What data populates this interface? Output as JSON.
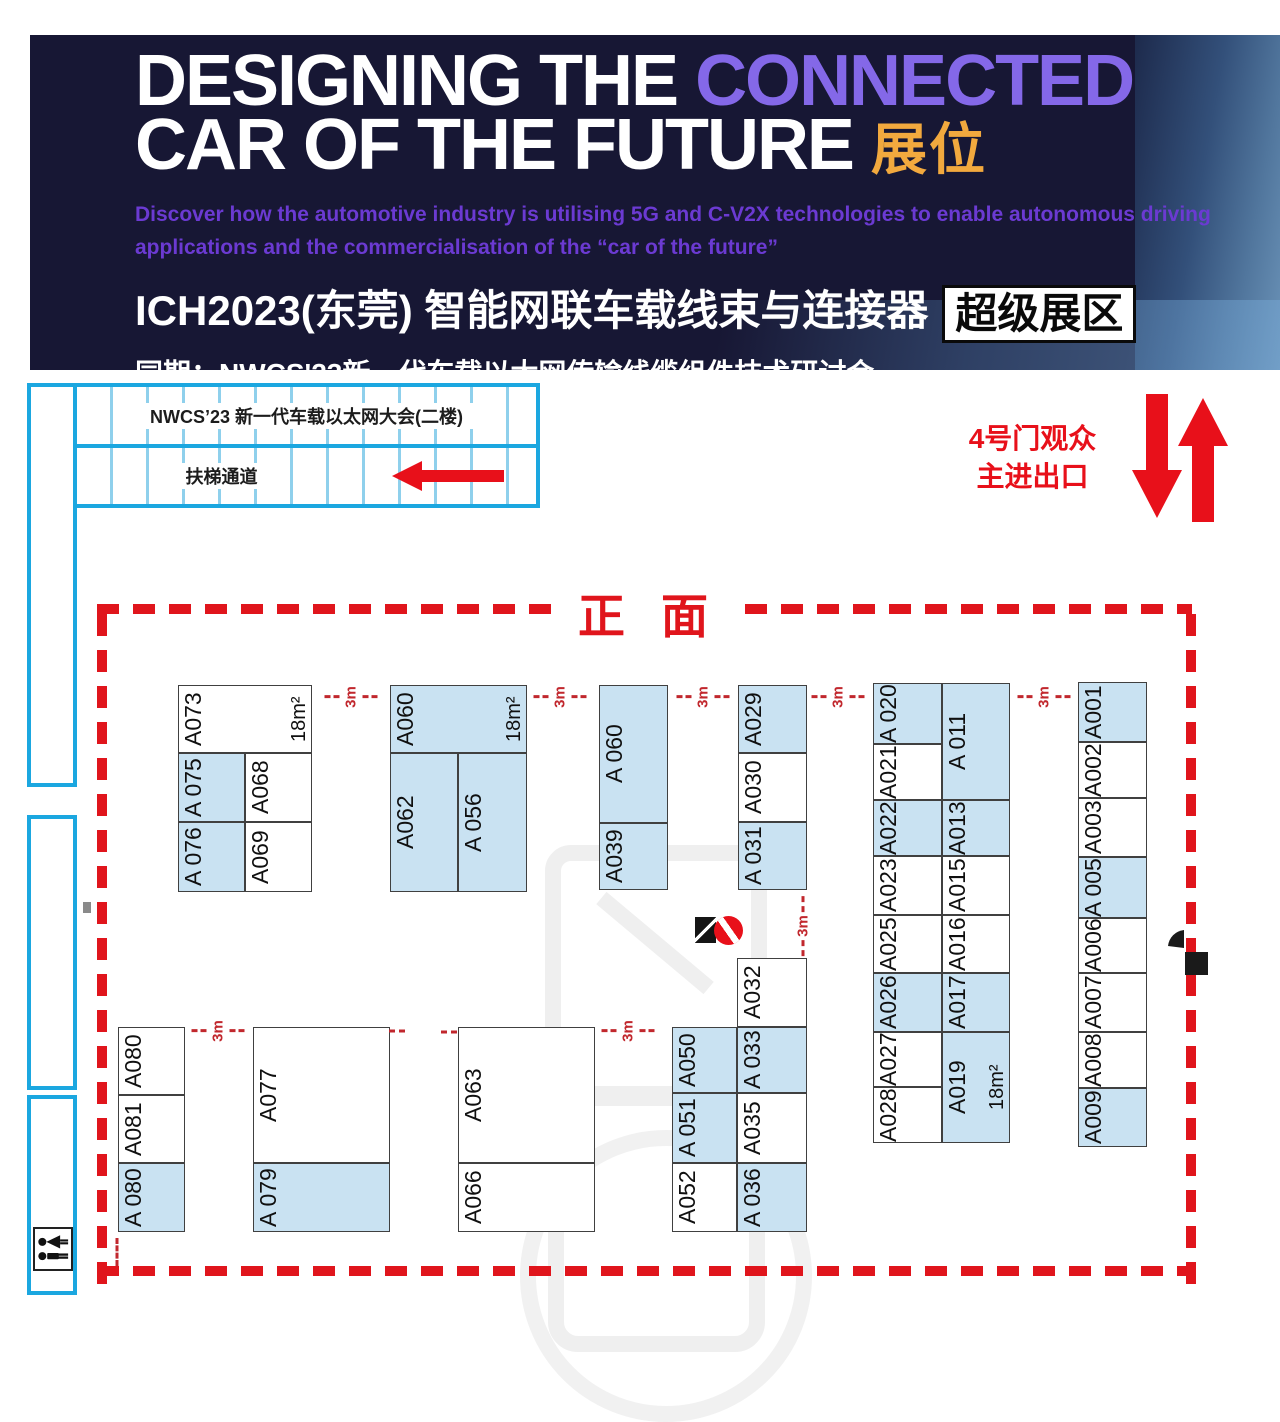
{
  "banner": {
    "bg_color": "#171734",
    "title": {
      "part1": "DESIGNING THE ",
      "accent": "CONNECTED",
      "part2": "CAR OF THE FUTURE ",
      "accent2": "展位",
      "accent_color": "#8468e8",
      "accent2_color": "#f2a93e"
    },
    "subtitle": {
      "line1": "Discover how the automotive industry is utilising 5G and C-V2X technologies to enable autonomous driving",
      "line2": "applications and the commercialisation of the “car of the future”",
      "color": "#6b3ad2"
    },
    "expo_line": {
      "text": "ICH2023(东莞) 智能网联车载线束与连接器",
      "badge": "超级展区"
    },
    "concurrent_line": "同期：NWCS'23新一代车载以太网传输线缆组件技术研讨会"
  },
  "stairs": {
    "hall_label": "NWCS’23 新一代车载以太网大会(二楼)",
    "escalator_label": "扶梯通道",
    "color": "#1ba7e0"
  },
  "entrance": {
    "line1": "4号门观众",
    "line2": "主进出口",
    "color": "#e8101a"
  },
  "front_label": "正面",
  "plan": {
    "booth_fill_blue": "#c9e2f2",
    "border_red": "#e0151c",
    "dim_red": "#c1272d",
    "booths": [
      {
        "label": "A073",
        "x": 178,
        "y": 685,
        "w": 134,
        "h": 68,
        "fill": "white",
        "area": "18m²"
      },
      {
        "label": "A 075",
        "x": 178,
        "y": 753,
        "w": 67,
        "h": 69,
        "fill": "blue"
      },
      {
        "label": "A068",
        "x": 245,
        "y": 753,
        "w": 67,
        "h": 69,
        "fill": "white"
      },
      {
        "label": "A 076",
        "x": 178,
        "y": 822,
        "w": 67,
        "h": 70,
        "fill": "blue"
      },
      {
        "label": "A069",
        "x": 245,
        "y": 822,
        "w": 67,
        "h": 70,
        "fill": "white"
      },
      {
        "label": "A060",
        "x": 390,
        "y": 685,
        "w": 137,
        "h": 68,
        "fill": "blue",
        "area": "18m²"
      },
      {
        "label": "A062",
        "x": 390,
        "y": 753,
        "w": 68,
        "h": 139,
        "fill": "blue"
      },
      {
        "label": "A 056",
        "x": 458,
        "y": 753,
        "w": 69,
        "h": 139,
        "fill": "blue"
      },
      {
        "label": "A 060",
        "x": 599,
        "y": 685,
        "w": 69,
        "h": 138,
        "fill": "blue"
      },
      {
        "label": "A039",
        "x": 599,
        "y": 823,
        "w": 69,
        "h": 67,
        "fill": "blue"
      },
      {
        "label": "A029",
        "x": 738,
        "y": 685,
        "w": 69,
        "h": 68,
        "fill": "blue"
      },
      {
        "label": "A030",
        "x": 738,
        "y": 753,
        "w": 69,
        "h": 69,
        "fill": "white"
      },
      {
        "label": "A 031",
        "x": 738,
        "y": 822,
        "w": 69,
        "h": 68,
        "fill": "blue"
      },
      {
        "label": "A 020",
        "x": 873,
        "y": 683,
        "w": 69,
        "h": 61,
        "fill": "blue"
      },
      {
        "label": "A021",
        "x": 873,
        "y": 744,
        "w": 69,
        "h": 56,
        "fill": "white"
      },
      {
        "label": "A022",
        "x": 873,
        "y": 800,
        "w": 69,
        "h": 56,
        "fill": "blue"
      },
      {
        "label": "A023",
        "x": 873,
        "y": 856,
        "w": 69,
        "h": 59,
        "fill": "white"
      },
      {
        "label": "A025",
        "x": 873,
        "y": 915,
        "w": 69,
        "h": 58,
        "fill": "white"
      },
      {
        "label": "A026",
        "x": 873,
        "y": 973,
        "w": 69,
        "h": 59,
        "fill": "blue"
      },
      {
        "label": "A027",
        "x": 873,
        "y": 1032,
        "w": 69,
        "h": 55,
        "fill": "white"
      },
      {
        "label": "A028",
        "x": 873,
        "y": 1087,
        "w": 69,
        "h": 56,
        "fill": "white"
      },
      {
        "label": "A 011",
        "x": 942,
        "y": 683,
        "w": 68,
        "h": 117,
        "fill": "blue"
      },
      {
        "label": "A013",
        "x": 942,
        "y": 800,
        "w": 68,
        "h": 56,
        "fill": "blue"
      },
      {
        "label": "A015",
        "x": 942,
        "y": 856,
        "w": 68,
        "h": 59,
        "fill": "white"
      },
      {
        "label": "A016",
        "x": 942,
        "y": 915,
        "w": 68,
        "h": 58,
        "fill": "white"
      },
      {
        "label": "A017",
        "x": 942,
        "y": 973,
        "w": 68,
        "h": 59,
        "fill": "blue"
      },
      {
        "label": "A019",
        "x": 942,
        "y": 1032,
        "w": 68,
        "h": 111,
        "fill": "blue",
        "area": "18m²"
      },
      {
        "label": "A001",
        "x": 1078,
        "y": 682,
        "w": 69,
        "h": 60,
        "fill": "blue"
      },
      {
        "label": "A002",
        "x": 1078,
        "y": 742,
        "w": 69,
        "h": 56,
        "fill": "white"
      },
      {
        "label": "A003",
        "x": 1078,
        "y": 798,
        "w": 69,
        "h": 59,
        "fill": "white"
      },
      {
        "label": "A 005",
        "x": 1078,
        "y": 857,
        "w": 69,
        "h": 61,
        "fill": "blue"
      },
      {
        "label": "A006",
        "x": 1078,
        "y": 918,
        "w": 69,
        "h": 55,
        "fill": "white"
      },
      {
        "label": "A007",
        "x": 1078,
        "y": 973,
        "w": 69,
        "h": 59,
        "fill": "white"
      },
      {
        "label": "A008",
        "x": 1078,
        "y": 1032,
        "w": 69,
        "h": 56,
        "fill": "white"
      },
      {
        "label": "A009",
        "x": 1078,
        "y": 1088,
        "w": 69,
        "h": 59,
        "fill": "blue"
      },
      {
        "label": "A080",
        "x": 118,
        "y": 1027,
        "w": 67,
        "h": 68,
        "fill": "white"
      },
      {
        "label": "A081",
        "x": 118,
        "y": 1095,
        "w": 67,
        "h": 68,
        "fill": "white"
      },
      {
        "label": "A 080",
        "x": 118,
        "y": 1163,
        "w": 67,
        "h": 69,
        "fill": "blue"
      },
      {
        "label": "A077",
        "x": 253,
        "y": 1027,
        "w": 137,
        "h": 136,
        "fill": "white"
      },
      {
        "label": "A 079",
        "x": 253,
        "y": 1163,
        "w": 137,
        "h": 69,
        "fill": "blue"
      },
      {
        "label": "A063",
        "x": 458,
        "y": 1027,
        "w": 137,
        "h": 136,
        "fill": "white"
      },
      {
        "label": "A066",
        "x": 458,
        "y": 1163,
        "w": 137,
        "h": 69,
        "fill": "white"
      },
      {
        "label": "A050",
        "x": 672,
        "y": 1027,
        "w": 65,
        "h": 66,
        "fill": "blue"
      },
      {
        "label": "A 051",
        "x": 672,
        "y": 1093,
        "w": 65,
        "h": 70,
        "fill": "blue"
      },
      {
        "label": "A052",
        "x": 672,
        "y": 1163,
        "w": 65,
        "h": 69,
        "fill": "white"
      },
      {
        "label": "A032",
        "x": 737,
        "y": 958,
        "w": 70,
        "h": 69,
        "fill": "white"
      },
      {
        "label": "A 033",
        "x": 737,
        "y": 1027,
        "w": 70,
        "h": 66,
        "fill": "blue"
      },
      {
        "label": "A035",
        "x": 737,
        "y": 1093,
        "w": 70,
        "h": 70,
        "fill": "white"
      },
      {
        "label": "A 036",
        "x": 737,
        "y": 1163,
        "w": 70,
        "h": 69,
        "fill": "blue"
      }
    ],
    "dims": [
      {
        "t": "3m",
        "x": 351,
        "y": 697,
        "o": "h"
      },
      {
        "t": "3m",
        "x": 560,
        "y": 697,
        "o": "h"
      },
      {
        "t": "3m",
        "x": 703,
        "y": 697,
        "o": "h"
      },
      {
        "t": "3m",
        "x": 838,
        "y": 697,
        "o": "h"
      },
      {
        "t": "3m",
        "x": 1044,
        "y": 697,
        "o": "h"
      },
      {
        "t": "3m",
        "x": 803,
        "y": 926,
        "o": "v"
      },
      {
        "t": "3m",
        "x": 218,
        "y": 1031,
        "o": "h"
      },
      {
        "t": "3m",
        "x": 628,
        "y": 1031,
        "o": "h"
      },
      {
        "t": "",
        "x": 397,
        "y": 1031,
        "o": "hd"
      },
      {
        "t": "",
        "x": 449,
        "y": 1032,
        "o": "hd"
      },
      {
        "t": "",
        "x": 117,
        "y": 1252,
        "o": "vd"
      }
    ]
  }
}
